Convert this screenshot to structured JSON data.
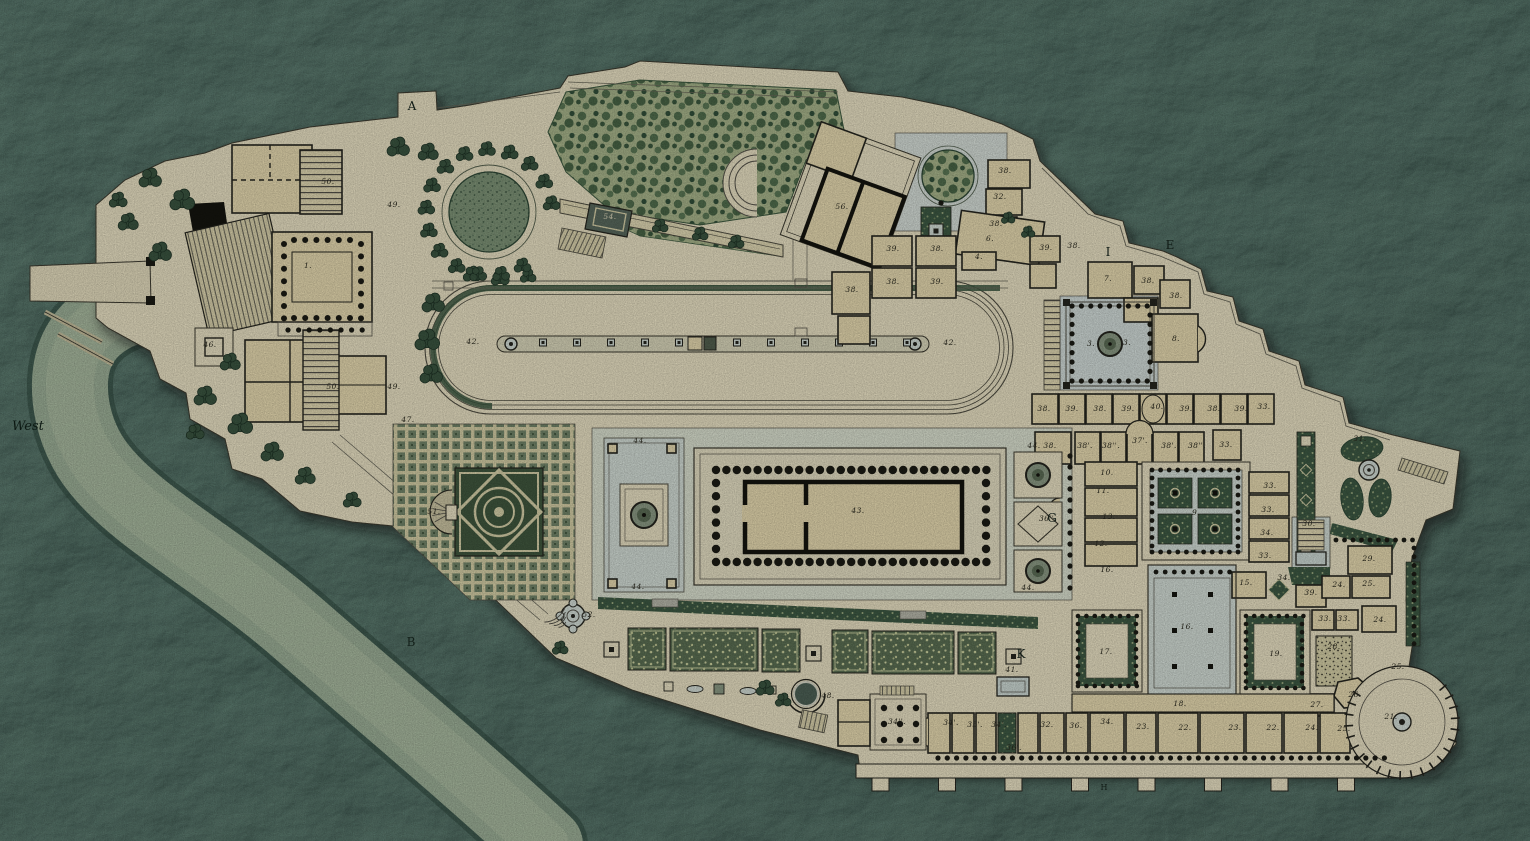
{
  "plate": {
    "compass_label": "West",
    "letters": [
      {
        "text": "West",
        "x": 12,
        "y": 430,
        "cls": "w"
      },
      {
        "text": "A",
        "x": 412,
        "y": 110,
        "cls": ""
      },
      {
        "text": "E",
        "x": 1170,
        "y": 249,
        "cls": ""
      },
      {
        "text": "I",
        "x": 1108,
        "y": 256,
        "cls": ""
      },
      {
        "text": "G",
        "x": 1052,
        "y": 522,
        "cls": ""
      },
      {
        "text": "K",
        "x": 1021,
        "y": 658,
        "cls": ""
      },
      {
        "text": "B",
        "x": 411,
        "y": 646,
        "cls": "rk"
      },
      {
        "text": "H",
        "x": 1104,
        "y": 790,
        "cls": "sm"
      }
    ],
    "numbers": [
      [
        "1.",
        308,
        268
      ],
      [
        "46.",
        210,
        347
      ],
      [
        "50.",
        328,
        184
      ],
      [
        "50.",
        333,
        389
      ],
      [
        "49.",
        394,
        207
      ],
      [
        "49.",
        394,
        389
      ],
      [
        "54.",
        610,
        219,
        "cr"
      ],
      [
        "56.",
        842,
        209
      ],
      [
        "38.",
        1005,
        173
      ],
      [
        "32.",
        1000,
        199
      ],
      [
        "38.",
        996,
        226
      ],
      [
        "6.",
        990,
        241
      ],
      [
        "4.",
        979,
        259
      ],
      [
        "39.",
        893,
        251
      ],
      [
        "38.",
        937,
        251
      ],
      [
        "38.",
        893,
        284
      ],
      [
        "39.",
        937,
        284
      ],
      [
        "38.",
        852,
        292
      ],
      [
        "39.",
        1046,
        250
      ],
      [
        "38.",
        1074,
        248
      ],
      [
        "7.",
        1108,
        281
      ],
      [
        "38.",
        1148,
        283
      ],
      [
        "38.",
        1176,
        298
      ],
      [
        "8.",
        1176,
        341
      ],
      [
        "3.",
        1091,
        346
      ],
      [
        "3.",
        1127,
        345
      ],
      [
        "38.",
        1044,
        411
      ],
      [
        "39.",
        1072,
        411
      ],
      [
        "38.",
        1100,
        411
      ],
      [
        "39.",
        1128,
        411
      ],
      [
        "40.",
        1157,
        409
      ],
      [
        "39.",
        1186,
        411
      ],
      [
        "38.",
        1214,
        411
      ],
      [
        "39.",
        1241,
        411
      ],
      [
        "33.",
        1264,
        409
      ],
      [
        "38.",
        1050,
        448
      ],
      [
        "38'.",
        1085,
        448
      ],
      [
        "38''.",
        1111,
        448
      ],
      [
        "37'.",
        1140,
        443
      ],
      [
        "38'.",
        1169,
        448
      ],
      [
        "38''.",
        1197,
        448
      ],
      [
        "33.",
        1226,
        447
      ],
      [
        "9.",
        1196,
        515
      ],
      [
        "10.",
        1107,
        475
      ],
      [
        "11.",
        1103,
        493
      ],
      [
        "13.",
        1109,
        519
      ],
      [
        "12.",
        1101,
        546
      ],
      [
        "16.",
        1107,
        572
      ],
      [
        "33.",
        1270,
        488
      ],
      [
        "33.",
        1268,
        512
      ],
      [
        "34.",
        1267,
        535
      ],
      [
        "33.",
        1265,
        558
      ],
      [
        "30.",
        1309,
        526
      ],
      [
        "31.",
        1360,
        441
      ],
      [
        "34.",
        1284,
        580
      ],
      [
        "15.",
        1246,
        585
      ],
      [
        "39.",
        1311,
        595
      ],
      [
        "33.",
        1325,
        621
      ],
      [
        "33.",
        1344,
        621
      ],
      [
        "28.",
        1334,
        649
      ],
      [
        "29.",
        1369,
        561
      ],
      [
        "24.",
        1339,
        587
      ],
      [
        "25.",
        1369,
        586
      ],
      [
        "24.",
        1380,
        622
      ],
      [
        "25.",
        1398,
        669
      ],
      [
        "26.",
        1355,
        697
      ],
      [
        "27.",
        1317,
        707
      ],
      [
        "21.",
        1391,
        719
      ],
      [
        "17.",
        1106,
        654
      ],
      [
        "16.",
        1187,
        629
      ],
      [
        "19.",
        1276,
        656
      ],
      [
        "18.",
        1180,
        706
      ],
      [
        "36''.",
        1048,
        521
      ],
      [
        "34''.",
        897,
        724
      ],
      [
        "34'.",
        951,
        725
      ],
      [
        "35'.",
        975,
        727
      ],
      [
        "34'.",
        999,
        727
      ],
      [
        "32.",
        1047,
        727
      ],
      [
        "36.",
        1076,
        728
      ],
      [
        "34.",
        1107,
        724
      ],
      [
        "23.",
        1143,
        729
      ],
      [
        "22.",
        1185,
        730
      ],
      [
        "23.",
        1235,
        730
      ],
      [
        "22.",
        1273,
        730
      ],
      [
        "24.",
        1312,
        730
      ],
      [
        "25.",
        1344,
        731
      ],
      [
        "36'.",
        1014,
        750
      ],
      [
        "41.",
        1012,
        672
      ],
      [
        "44.",
        640,
        443
      ],
      [
        "44.",
        638,
        589
      ],
      [
        "44.",
        1034,
        448
      ],
      [
        "44.",
        1028,
        590
      ],
      [
        "43.",
        858,
        513
      ],
      [
        "42.",
        473,
        344
      ],
      [
        "42.",
        950,
        345
      ],
      [
        "47.",
        408,
        422
      ],
      [
        "51.",
        434,
        514
      ],
      [
        "52.",
        589,
        617
      ],
      [
        "48.",
        828,
        698
      ]
    ],
    "palette": {
      "rock_teal": "#33524a",
      "plateau_cream": "#ece4c6",
      "building_tan": "#e9dcb2",
      "wall_ink": "#26261f",
      "garden_dark": "#3e5a44",
      "foliage_light": "#a9b68c",
      "pavement_blue": "#d5dfd8",
      "road_green": "#a3b69d",
      "label_ink": "#2b2a1f"
    }
  }
}
